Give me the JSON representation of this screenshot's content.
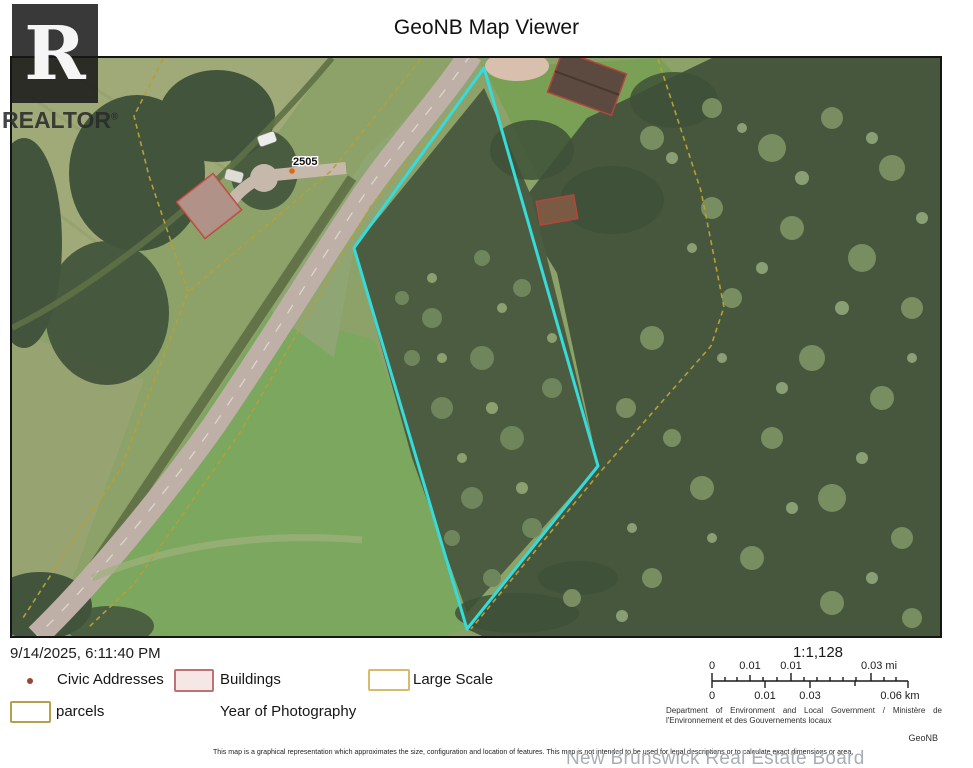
{
  "header": {
    "title": "GeoNB Map Viewer"
  },
  "realtor_logo": {
    "letter": "R",
    "brand": "REALTOR",
    "registered": "®"
  },
  "map": {
    "civic_address_label": "2505",
    "colors": {
      "parcel_highlight": "#36DBDB",
      "parcel_boundary": "#B89F35",
      "building_outline": "#B5453A",
      "civic_address_dot": "#E2680F",
      "road": "#BEB0A6",
      "field": "#8CA269",
      "forest": "#46573D"
    }
  },
  "footer": {
    "timestamp": "9/14/2025, 6:11:40 PM",
    "legend": {
      "items": [
        {
          "label": "Civic Addresses",
          "symbol": "dot",
          "color": "#9C4434"
        },
        {
          "label": "Buildings",
          "symbol": "rect",
          "fill": "#F6E7E7",
          "stroke": "#BE7273"
        },
        {
          "label": "Large Scale",
          "symbol": "rect",
          "fill": "#FFFFFF",
          "stroke": "#D9B96A"
        },
        {
          "label": "parcels",
          "symbol": "rect",
          "fill": "#FFFFFF",
          "stroke": "#B3A24B"
        },
        {
          "label": "Year of Photography",
          "symbol": "none"
        }
      ]
    },
    "scale": {
      "ratio": "1:1,128",
      "mi_ticks": [
        "0",
        "0.01",
        "0.01",
        "0.03 mi"
      ],
      "km_ticks": [
        "0",
        "0.01",
        "0.03",
        "0.06 km"
      ]
    },
    "attribution": "Department of Environment and Local Government / Ministère de l'Environnement et des Gouvernements locaux",
    "geonb_credit": "GeoNB",
    "disclaimer": "This map is a graphical representation which approximates the size, configuration and location of features. This map is not intended to be used for legal descriptions or to calculate exact dimensions or area.",
    "board_watermark": "New Brunswick Real Estate Board"
  }
}
